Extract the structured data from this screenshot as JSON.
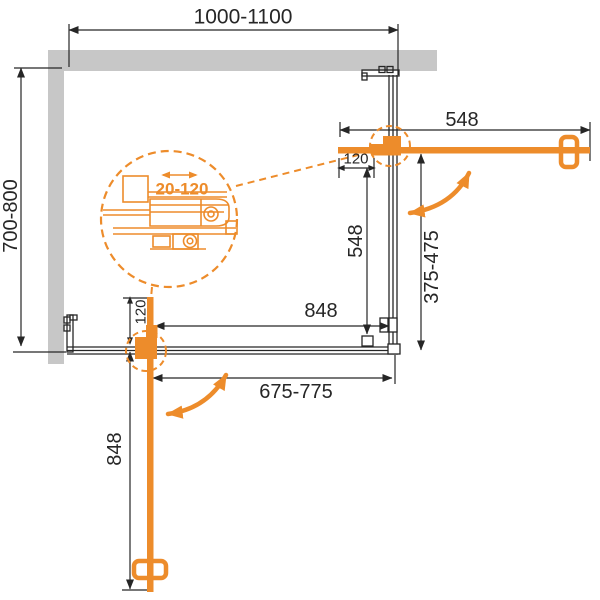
{
  "drawing": {
    "dimensions": {
      "top_width": "1000-1100",
      "side_depth": "700-800",
      "right_door_open_length": "548",
      "right_hinge_offset": "120",
      "right_door_closed_length": "548",
      "right_opening_width": "375-475",
      "front_door_closed_length": "848",
      "front_opening_width": "675-775",
      "front_hinge_offset": "120",
      "front_door_open_length": "848",
      "detail_adjustment_range": "20-120"
    },
    "colors": {
      "accent_orange": "#ED8C2B",
      "wall_gray": "#C7C7C7",
      "line_black": "#262626"
    }
  }
}
